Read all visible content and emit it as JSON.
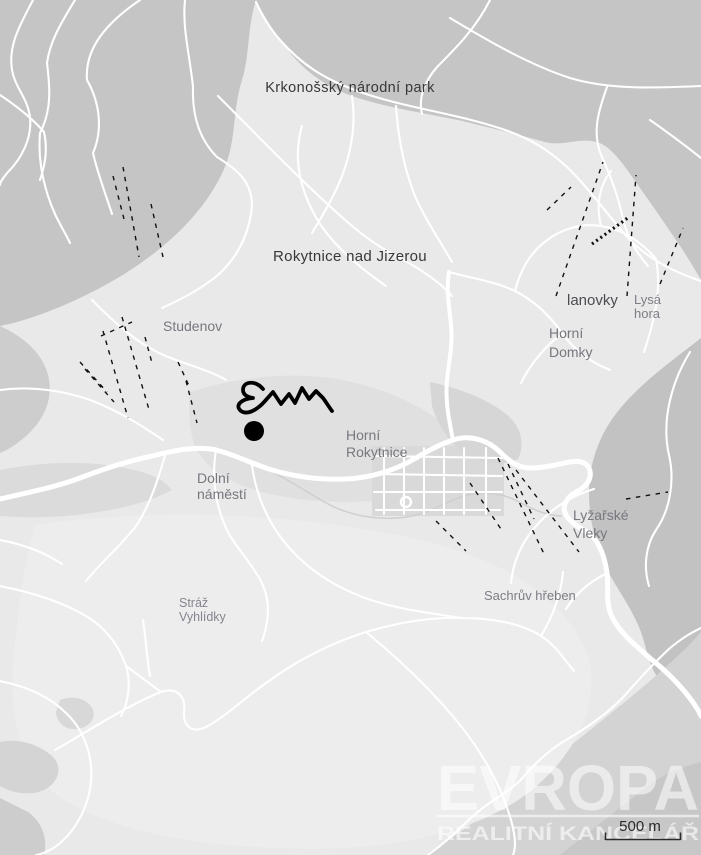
{
  "map": {
    "type": "area-overview-map",
    "area": "Rokytnice nad Jizerou",
    "place_labels": [
      {
        "name": "krkonossky-narodni-park",
        "lines": [
          "Krkonošský národní park"
        ]
      },
      {
        "name": "rokytnice-nad-jizerou",
        "lines": [
          "Rokytnice nad Jizerou"
        ]
      },
      {
        "name": "studenov",
        "lines": [
          "Studenov"
        ]
      },
      {
        "name": "lanovky",
        "lines": [
          "lanovky"
        ]
      },
      {
        "name": "lysa-hora",
        "lines": [
          "Lysá",
          "hora"
        ]
      },
      {
        "name": "horni-domky",
        "lines": [
          "Horní",
          "Domky"
        ]
      },
      {
        "name": "horni-rokytnice",
        "lines": [
          "Horní",
          "Rokytnice"
        ]
      },
      {
        "name": "dolni-namesti",
        "lines": [
          "Dolní",
          "náměstí"
        ]
      },
      {
        "name": "lyzarske-vleky",
        "lines": [
          "Lyžařské",
          "Vleky"
        ]
      },
      {
        "name": "straz-vyhlidky",
        "lines": [
          "Stráž",
          "Vyhlídky"
        ]
      },
      {
        "name": "sachruv-hreben",
        "lines": [
          "Sachrův hřeben"
        ]
      }
    ],
    "marker": {
      "shape": "filled-circle",
      "color": "#000000"
    },
    "annotation": {
      "shape": "hand-drawn-scribble",
      "color": "#000000"
    },
    "scale_bar": {
      "label": "500 m"
    },
    "watermark": {
      "brand": "EVROPA",
      "subtitle": "REALITNÍ KANCELÁŘ"
    },
    "colors": {
      "terrain_light": "#e9e9e9",
      "terrain_dark": "#c5c5c5",
      "terrain_mid": "#d4d4d4",
      "road": "#ffffff",
      "ski_lift_dash": "#111111",
      "label_dark": "#38383a",
      "label_gray": "#77777f",
      "marker": "#000000",
      "watermark": "rgba(255,255,255,0.55)"
    }
  }
}
